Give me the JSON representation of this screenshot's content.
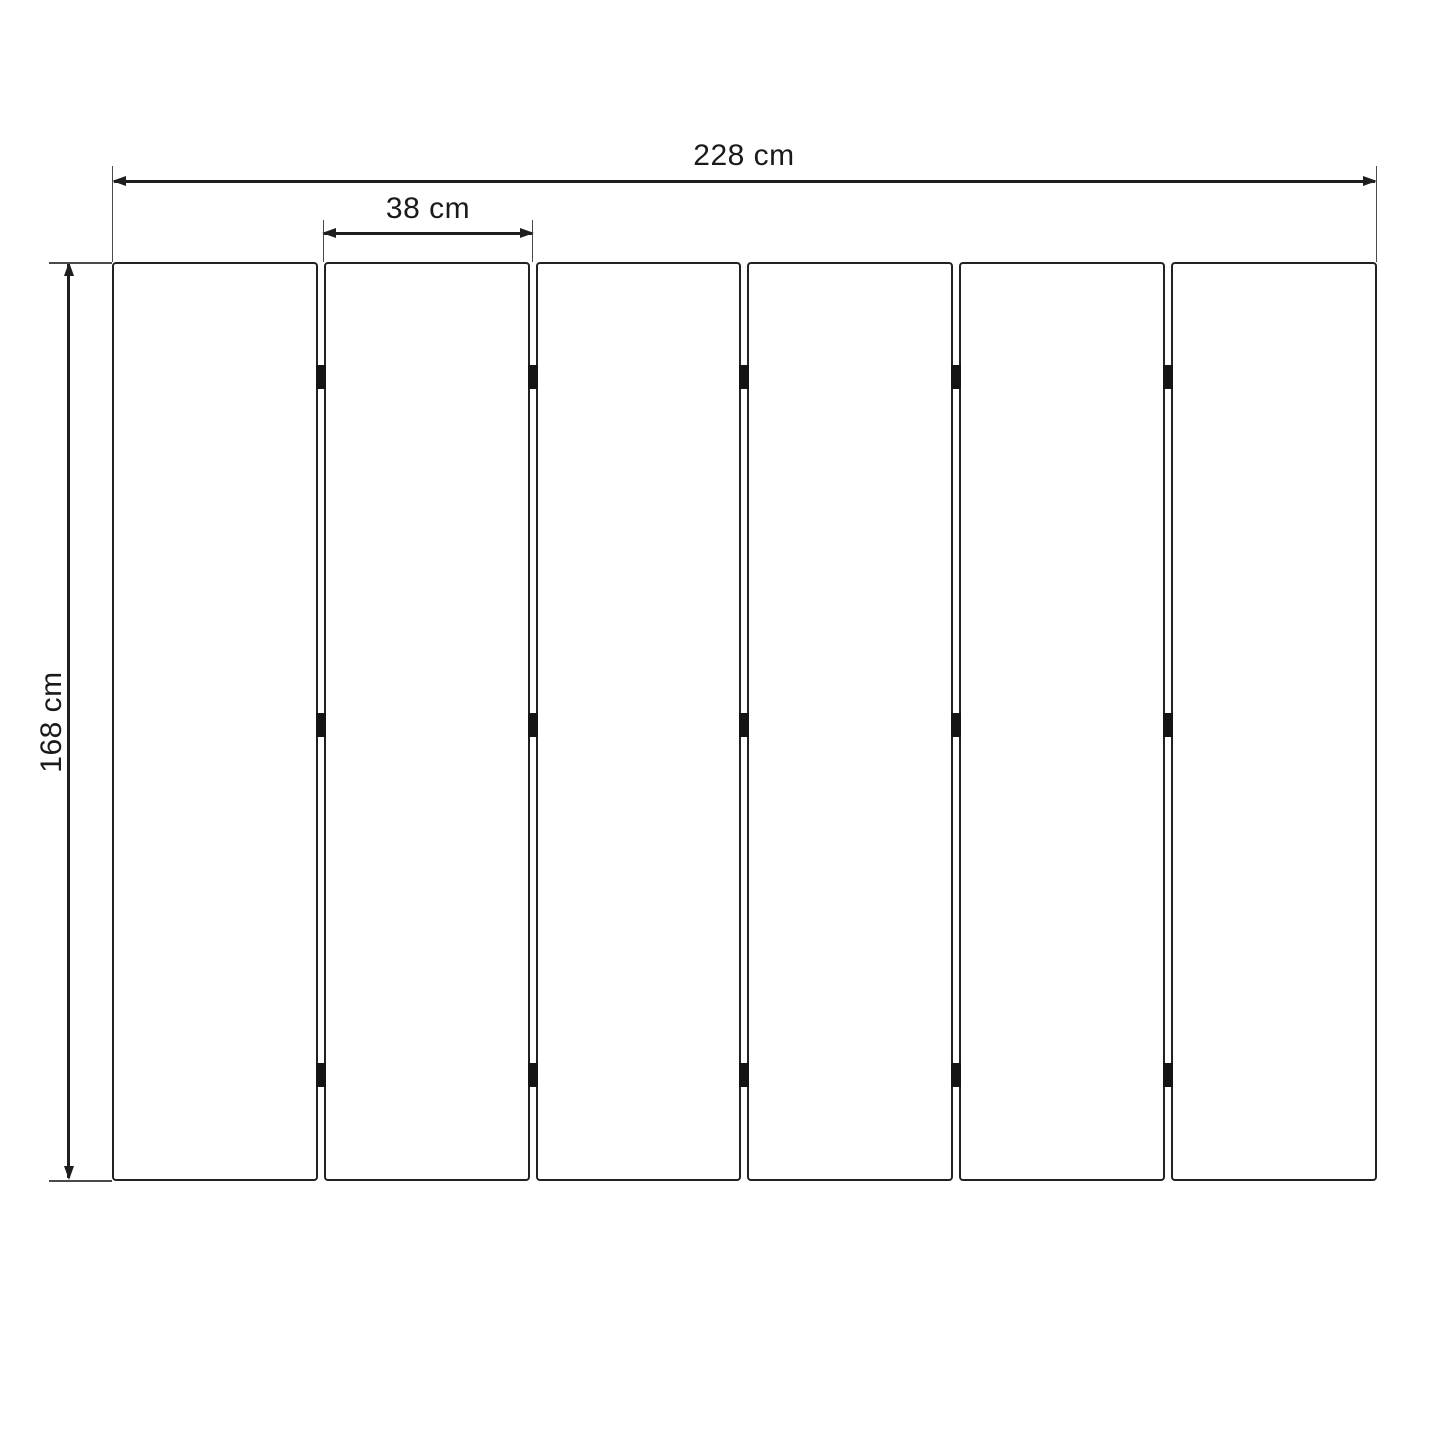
{
  "diagram": {
    "title": "panel dimension drawing",
    "labels": {
      "total_width": "228 cm",
      "panel_width": "38 cm",
      "height": "168 cm"
    },
    "panel_count": 6,
    "gap_count": 5,
    "hinge_rows": 3,
    "colors": {
      "background": "#ffffff",
      "line": "#1e1e1e",
      "panel_fill": "#ffffff",
      "hinge": "#141414"
    }
  }
}
